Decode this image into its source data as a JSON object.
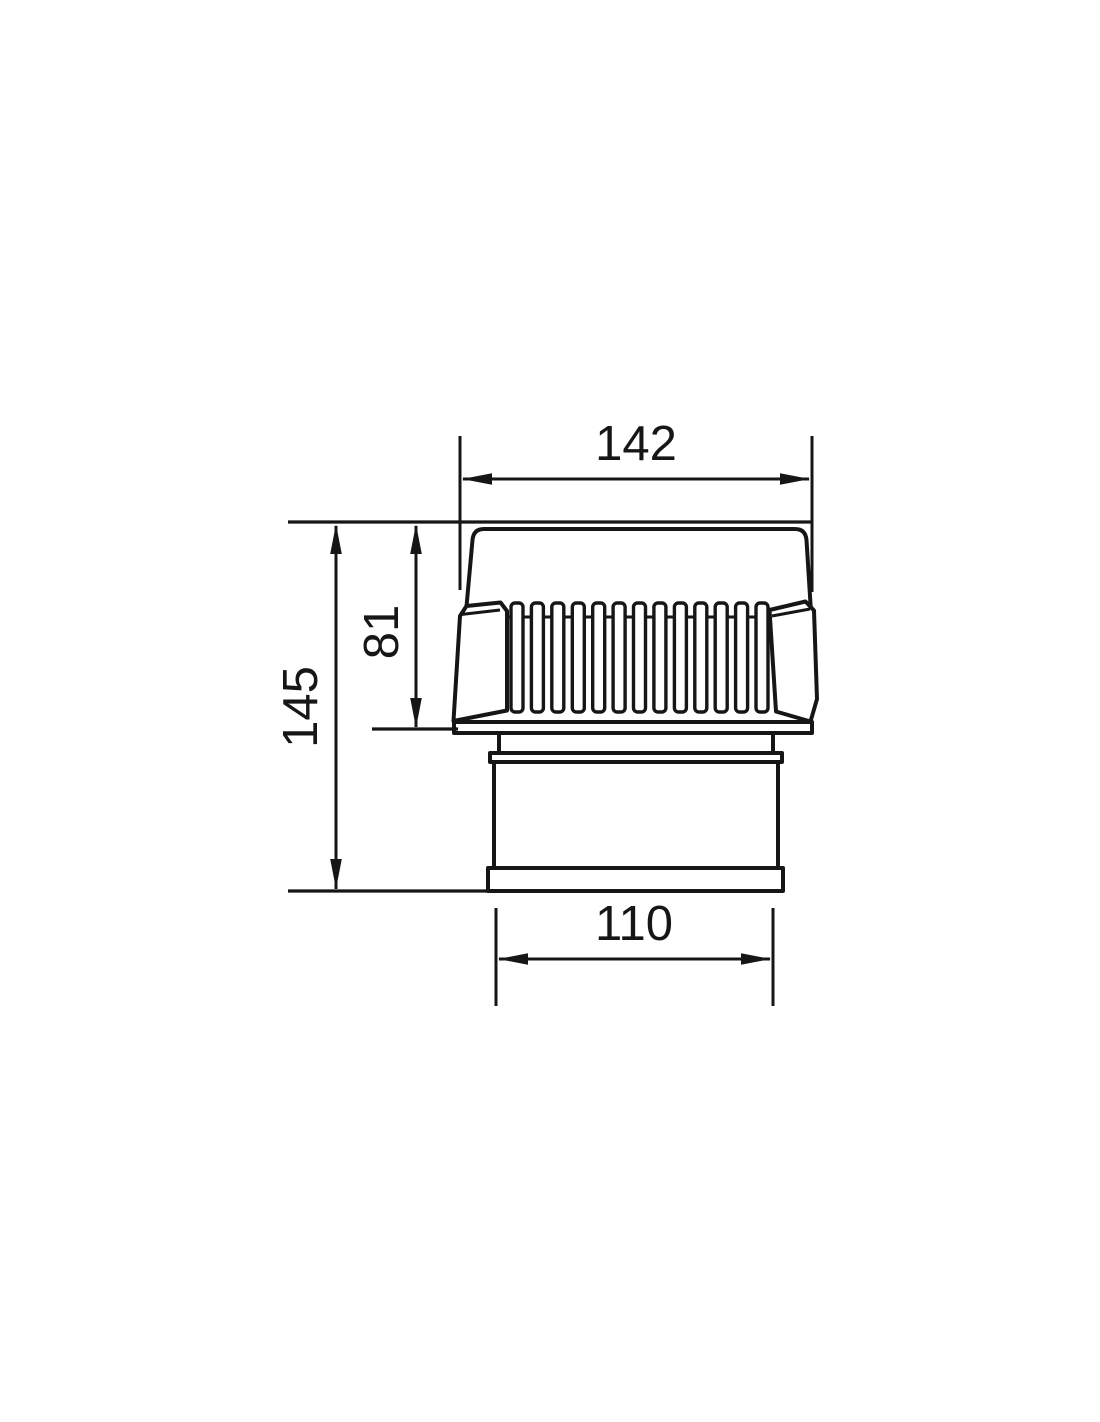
{
  "document": {
    "type": "technical-dimension-drawing",
    "view": "side-elevation",
    "background_color": "#ffffff",
    "line_color": "#161616"
  },
  "part": {
    "name": "ribbed-vent-cap-with-spigot",
    "fin_count": 13,
    "fin_geometry": {
      "x_start": 511,
      "pitch": 20.42,
      "width": 12,
      "y_top": 603,
      "height": 109,
      "corner_radius": 4
    }
  },
  "dimensions": {
    "top_width": {
      "label": "142",
      "value": 142
    },
    "ribbed_height": {
      "label": "81",
      "value": 81
    },
    "overall_height": {
      "label": "145",
      "value": 145
    },
    "spigot_width": {
      "label": "110",
      "value": 110
    }
  }
}
